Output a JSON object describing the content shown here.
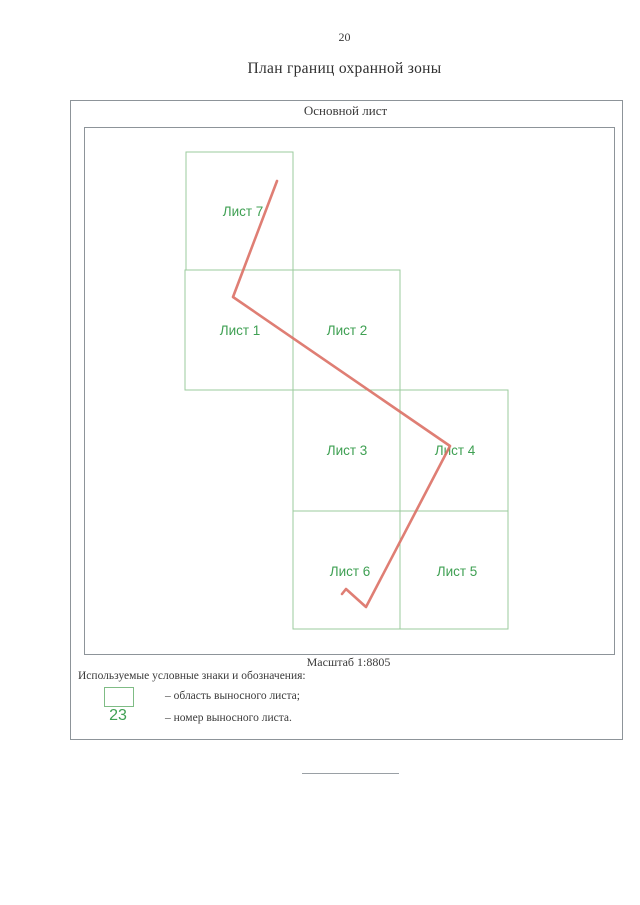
{
  "page": {
    "number": "20",
    "title": "План границ охранной зоны"
  },
  "plan": {
    "main_sheet_label": "Основной лист",
    "scale_label": "Масштаб 1:8805",
    "sheets": [
      {
        "label": "Лист 7"
      },
      {
        "label": "Лист 1"
      },
      {
        "label": "Лист 2"
      },
      {
        "label": "Лист 3"
      },
      {
        "label": "Лист 4"
      },
      {
        "label": "Лист 6"
      },
      {
        "label": "Лист 5"
      }
    ],
    "boundary_line": {
      "points": "277,181 233,297 450,446 366,607 346,589 342,594",
      "color": "#dc7065"
    }
  },
  "legend": {
    "heading": "Используемые условные знаки и обозначения:",
    "items": [
      {
        "symbol": "green-area-box",
        "text": "– область выносного листа;"
      },
      {
        "symbol": "23",
        "text": "– номер выносного листа."
      }
    ]
  },
  "colors": {
    "sheet_box_green": "#9bcb9e",
    "sheet_text_green": "#3fa053",
    "boundary_red": "#dc7065",
    "border_gray": "#8d9499"
  }
}
